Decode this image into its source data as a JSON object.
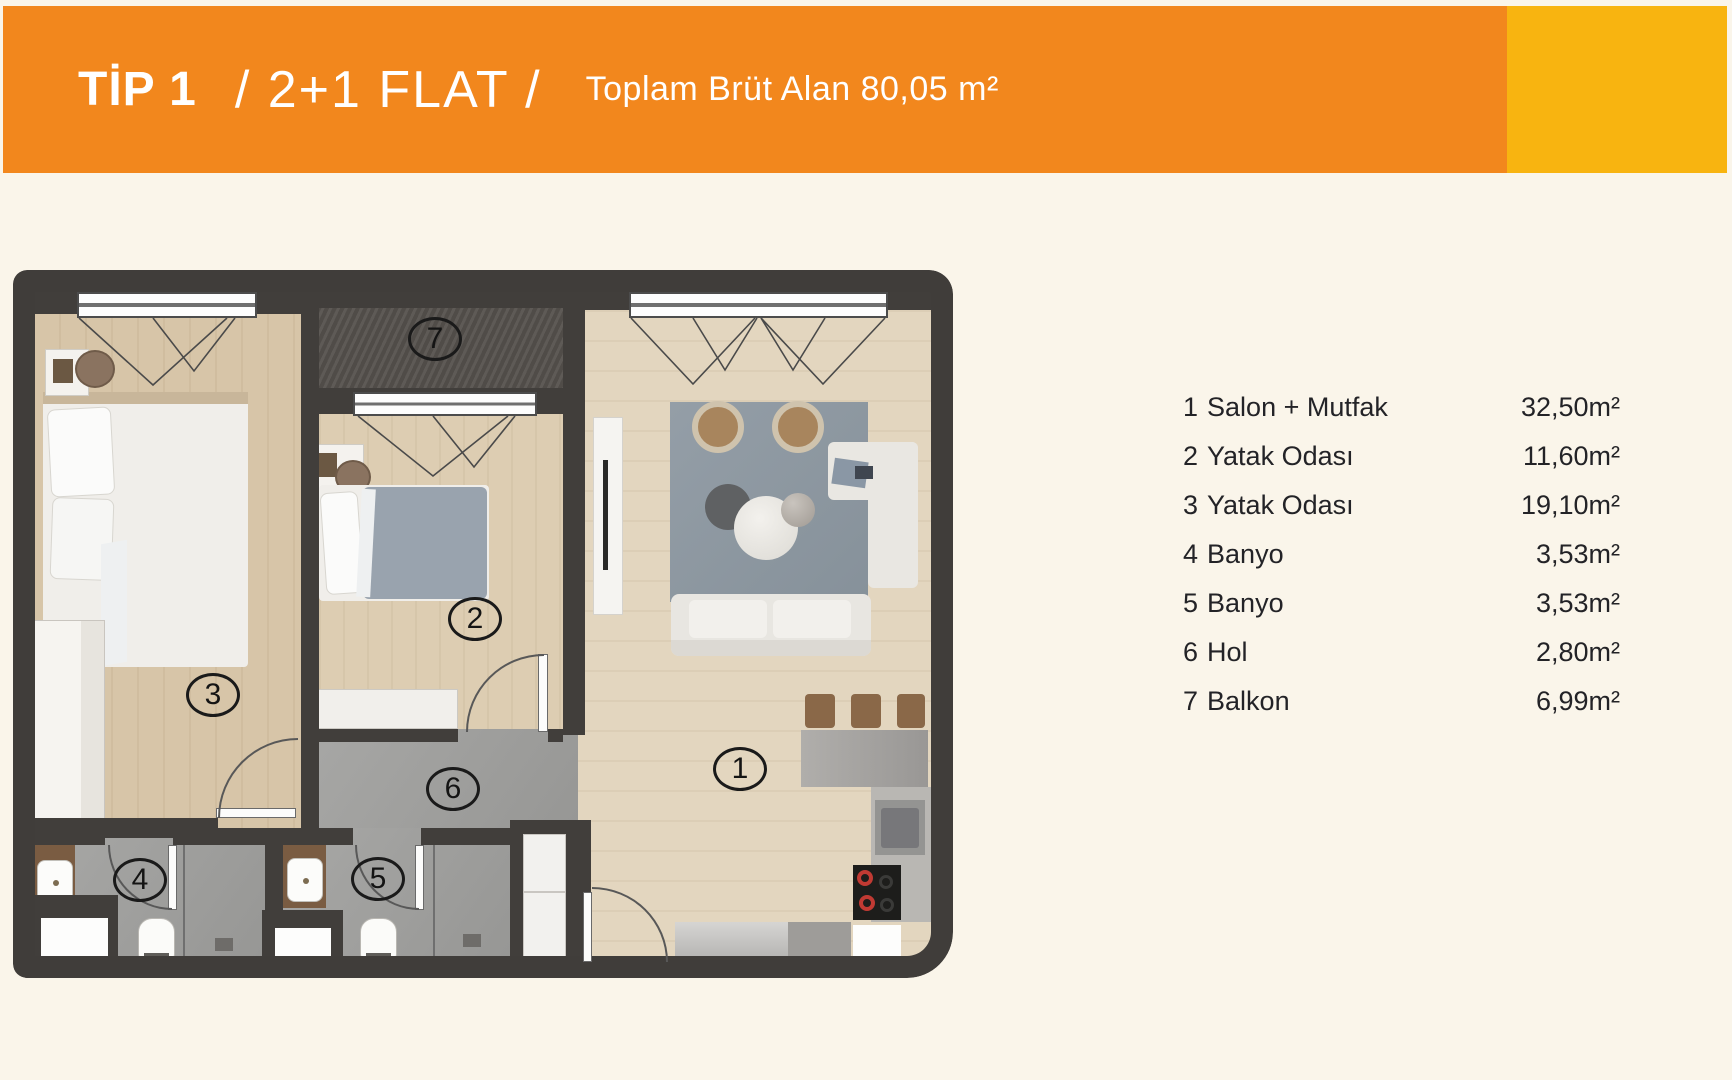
{
  "header": {
    "type_label": "TİP 1",
    "flat_label": "/ 2+1 FLAT /",
    "area_label": "Toplam Brüt Alan 80,05 m²",
    "colors": {
      "bar_orange": "#f2871d",
      "accent_yellow": "#f8b410",
      "background_cream": "#faf5ea"
    }
  },
  "legend": {
    "rooms": [
      {
        "num": "1",
        "label": "Salon + Mutfak",
        "area": "32,50m²"
      },
      {
        "num": "2",
        "label": "Yatak Odası",
        "area": "11,60m²"
      },
      {
        "num": "3",
        "label": "Yatak Odası",
        "area": "19,10m²"
      },
      {
        "num": "4",
        "label": "Banyo",
        "area": "3,53m²"
      },
      {
        "num": "5",
        "label": "Banyo",
        "area": "3,53m²"
      },
      {
        "num": "6",
        "label": "Hol",
        "area": "2,80m²"
      },
      {
        "num": "7",
        "label": "Balkon",
        "area": "6,99m²"
      }
    ]
  }
}
